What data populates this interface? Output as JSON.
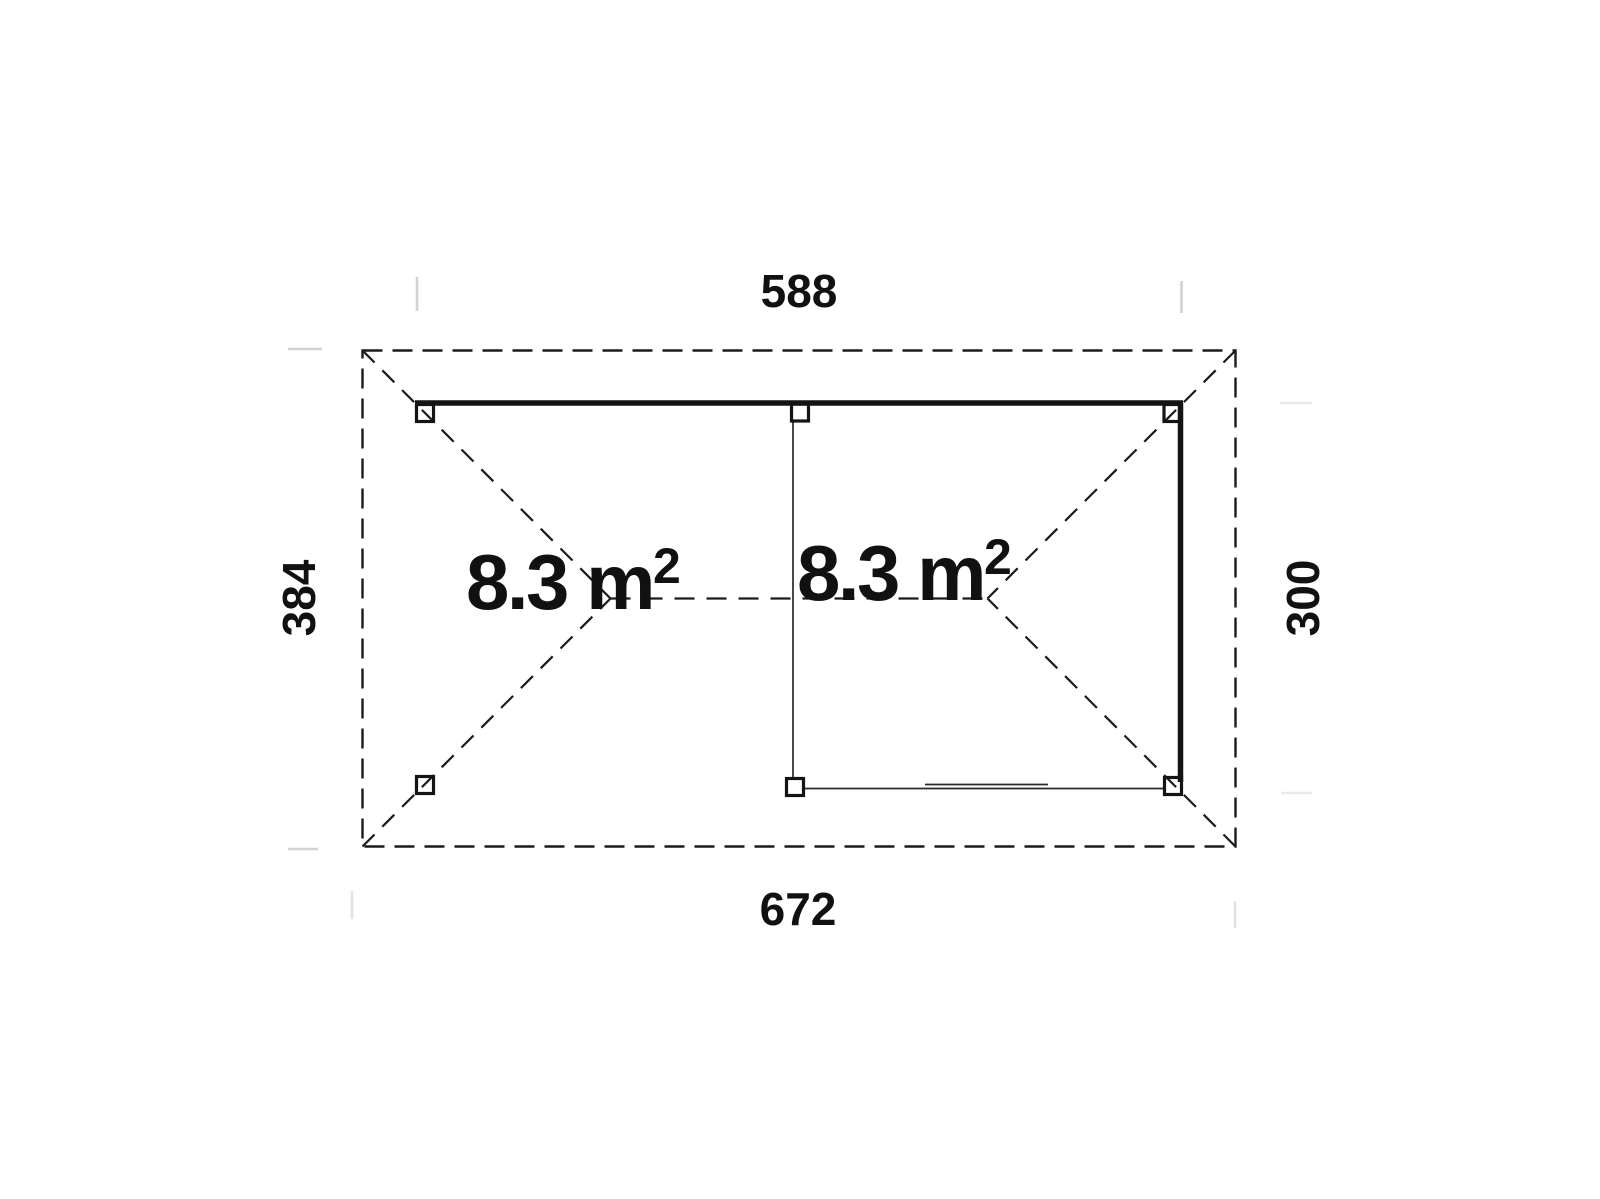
{
  "plan": {
    "title": "hip-roof garden structure floor plan",
    "dimensions": {
      "top": "588",
      "bottom": "672",
      "left": "384",
      "right": "300"
    },
    "areas": {
      "left_label": "8.3 m",
      "left_sup": "2",
      "right_label": "8.3 m",
      "right_sup": "2"
    }
  },
  "colors": {
    "line": "#1b1b1b",
    "structure": "#141414",
    "text": "#111111",
    "tick": "#d2d2d2",
    "tick_faint": "#eaeaea",
    "background": "#ffffff"
  }
}
